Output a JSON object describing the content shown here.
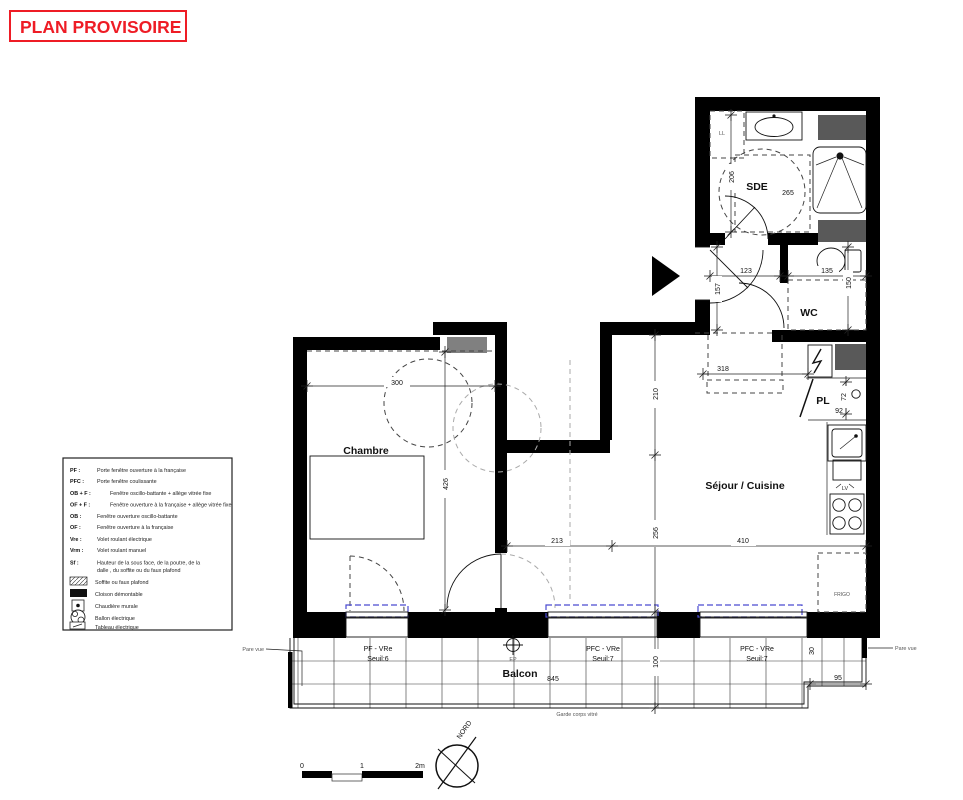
{
  "title": "PLAN PROVISOIRE",
  "legend": {
    "abbrev_items": [
      {
        "key": "PF :",
        "text": "Porte fenêtre ouverture à la française"
      },
      {
        "key": "PFC :",
        "text": "Porte fenêtre coulissante"
      },
      {
        "key": "OB + F :",
        "text": "Fenêtre oscillo-battante + allège vitrée fixe"
      },
      {
        "key": "OF + F :",
        "text": "Fenêtre ouverture à la française + allège vitrée fixe"
      },
      {
        "key": "OB :",
        "text": "Fenêtre ouverture oscillo-battante"
      },
      {
        "key": "OF :",
        "text": "Fenêtre ouverture à la française"
      },
      {
        "key": "Vre :",
        "text": "Volet roulant électrique"
      },
      {
        "key": "Vrm :",
        "text": "Volet roulant manuel"
      },
      {
        "key": "Sf :",
        "text": "Hauteur de la sous face, de la poutre, de la",
        "text2": "dalle , du soffite ou du faux plafond"
      }
    ],
    "symbol_items": [
      {
        "icon": "hatch-swatch",
        "text": "Soffite ou faux plafond"
      },
      {
        "icon": "black-swatch",
        "text": "Cloison démontable"
      },
      {
        "icon": "boiler-icon",
        "text": "Chaudière murale"
      },
      {
        "icon": "tank-icon",
        "text": "Ballon électrique"
      },
      {
        "icon": "panel-icon",
        "text": "Tableau électrique"
      }
    ]
  },
  "rooms": {
    "chambre": "Chambre",
    "sejour": "Séjour / Cuisine",
    "sde": "SDE",
    "wc": "WC",
    "pl": "PL",
    "balcon": "Balcon"
  },
  "fixtures": {
    "ll": "LL",
    "lv": "LV",
    "frigo": "FRIGO"
  },
  "dims": {
    "chambre_w": "300",
    "chambre_h": "426",
    "sde_h": "206",
    "sde_w": "265",
    "hall_w": "123",
    "hall_h": "157",
    "wc_w": "135",
    "wc_h": "150",
    "entry_w": "318",
    "sejour_h1": "210",
    "sejour_h2": "256",
    "sejour_w1": "213",
    "sejour_w2": "410",
    "pl_h": "72",
    "pl_w": "92",
    "balcon_l": "845",
    "balcon_d": "100",
    "balcon_step": "30",
    "balcon_r": "95"
  },
  "windows": {
    "w1_type": "PF - VRe",
    "w1_seuil": "Seuil:6",
    "w2_type": "PFC - VRe",
    "w2_seuil": "Seuil:7",
    "w3_type": "PFC - VRe",
    "w3_seuil": "Seuil:7"
  },
  "annotations": {
    "pare_vue_left": "Pare vue",
    "pare_vue_right": "Pare vue",
    "garde_corps": "Garde corps vitré",
    "ep": "EP",
    "nord": "NORD"
  },
  "scale_bar": {
    "zero": "0",
    "one": "1",
    "two": "2m"
  },
  "colors": {
    "accent_red": "#ee1c25",
    "wall": "#000000",
    "shaft_dark": "#595959",
    "shaft_light": "#808080",
    "sill_blue": "#4a4ad0"
  }
}
